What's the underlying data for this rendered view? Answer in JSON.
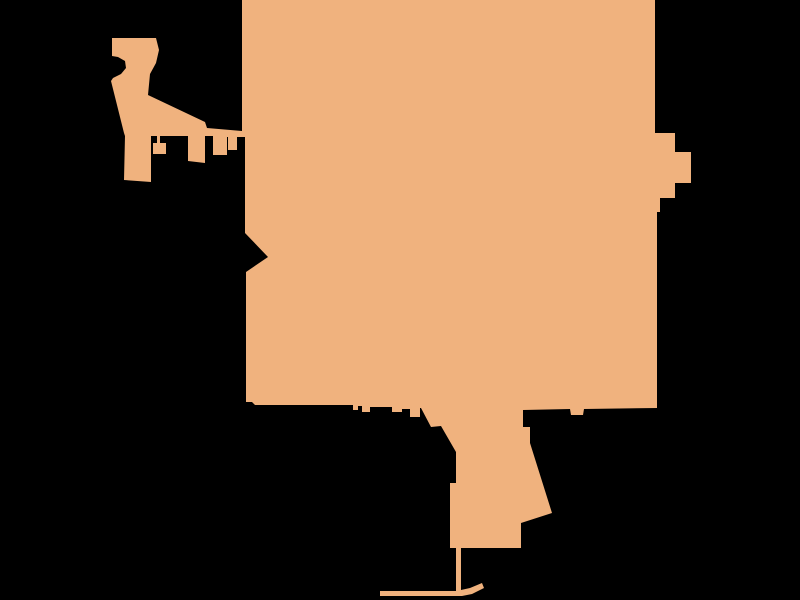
{
  "canvas": {
    "width": 800,
    "height": 600,
    "background_color": "#000000"
  },
  "map": {
    "region_fill": "#F0B27E",
    "region_stroke": "none",
    "outline": [
      [
        242,
        0
      ],
      [
        655,
        0
      ],
      [
        655,
        133
      ],
      [
        675,
        133
      ],
      [
        675,
        152
      ],
      [
        691,
        152
      ],
      [
        691,
        183
      ],
      [
        675,
        183
      ],
      [
        675,
        198
      ],
      [
        660,
        198
      ],
      [
        660,
        212
      ],
      [
        657,
        212
      ],
      [
        657,
        408
      ],
      [
        584,
        409
      ],
      [
        583,
        415
      ],
      [
        571,
        415
      ],
      [
        570,
        409
      ],
      [
        523,
        410
      ],
      [
        523,
        427
      ],
      [
        530,
        427
      ],
      [
        530,
        443
      ],
      [
        552,
        513
      ],
      [
        521,
        523
      ],
      [
        521,
        548
      ],
      [
        461,
        548
      ],
      [
        461,
        590
      ],
      [
        470,
        588
      ],
      [
        482,
        583
      ],
      [
        484,
        588
      ],
      [
        472,
        594
      ],
      [
        462,
        596
      ],
      [
        380,
        596
      ],
      [
        380,
        591
      ],
      [
        456,
        591
      ],
      [
        456,
        548
      ],
      [
        450,
        548
      ],
      [
        450,
        483
      ],
      [
        456,
        483
      ],
      [
        456,
        452
      ],
      [
        441,
        426
      ],
      [
        431,
        427
      ],
      [
        421,
        408
      ],
      [
        420,
        408
      ],
      [
        420,
        417
      ],
      [
        410,
        417
      ],
      [
        410,
        409
      ],
      [
        402,
        409
      ],
      [
        402,
        412
      ],
      [
        392,
        412
      ],
      [
        392,
        407
      ],
      [
        370,
        407
      ],
      [
        370,
        412
      ],
      [
        362,
        412
      ],
      [
        362,
        406
      ],
      [
        358,
        406
      ],
      [
        358,
        410
      ],
      [
        353,
        410
      ],
      [
        353,
        405
      ],
      [
        255,
        405
      ],
      [
        252,
        402
      ],
      [
        246,
        402
      ],
      [
        246,
        272
      ],
      [
        268,
        257
      ],
      [
        245,
        233
      ],
      [
        245,
        137
      ],
      [
        237,
        137
      ],
      [
        237,
        150
      ],
      [
        228,
        150
      ],
      [
        228,
        137
      ],
      [
        227,
        137
      ],
      [
        227,
        155
      ],
      [
        213,
        155
      ],
      [
        213,
        136
      ],
      [
        205,
        136
      ],
      [
        205,
        163
      ],
      [
        188,
        161
      ],
      [
        188,
        136
      ],
      [
        160,
        136
      ],
      [
        160,
        143
      ],
      [
        166,
        143
      ],
      [
        166,
        154
      ],
      [
        153,
        154
      ],
      [
        153,
        143
      ],
      [
        157,
        143
      ],
      [
        157,
        136
      ],
      [
        151,
        136
      ],
      [
        151,
        182
      ],
      [
        124,
        180
      ],
      [
        125,
        136
      ],
      [
        124,
        133
      ],
      [
        111,
        81
      ],
      [
        113,
        78
      ],
      [
        121,
        74
      ],
      [
        126,
        68
      ],
      [
        125,
        61
      ],
      [
        118,
        57
      ],
      [
        112,
        56
      ],
      [
        112,
        38
      ],
      [
        156,
        38
      ],
      [
        159,
        50
      ],
      [
        156,
        63
      ],
      [
        150,
        74
      ],
      [
        148,
        95
      ],
      [
        205,
        122
      ],
      [
        207,
        128
      ],
      [
        242,
        131
      ]
    ]
  }
}
